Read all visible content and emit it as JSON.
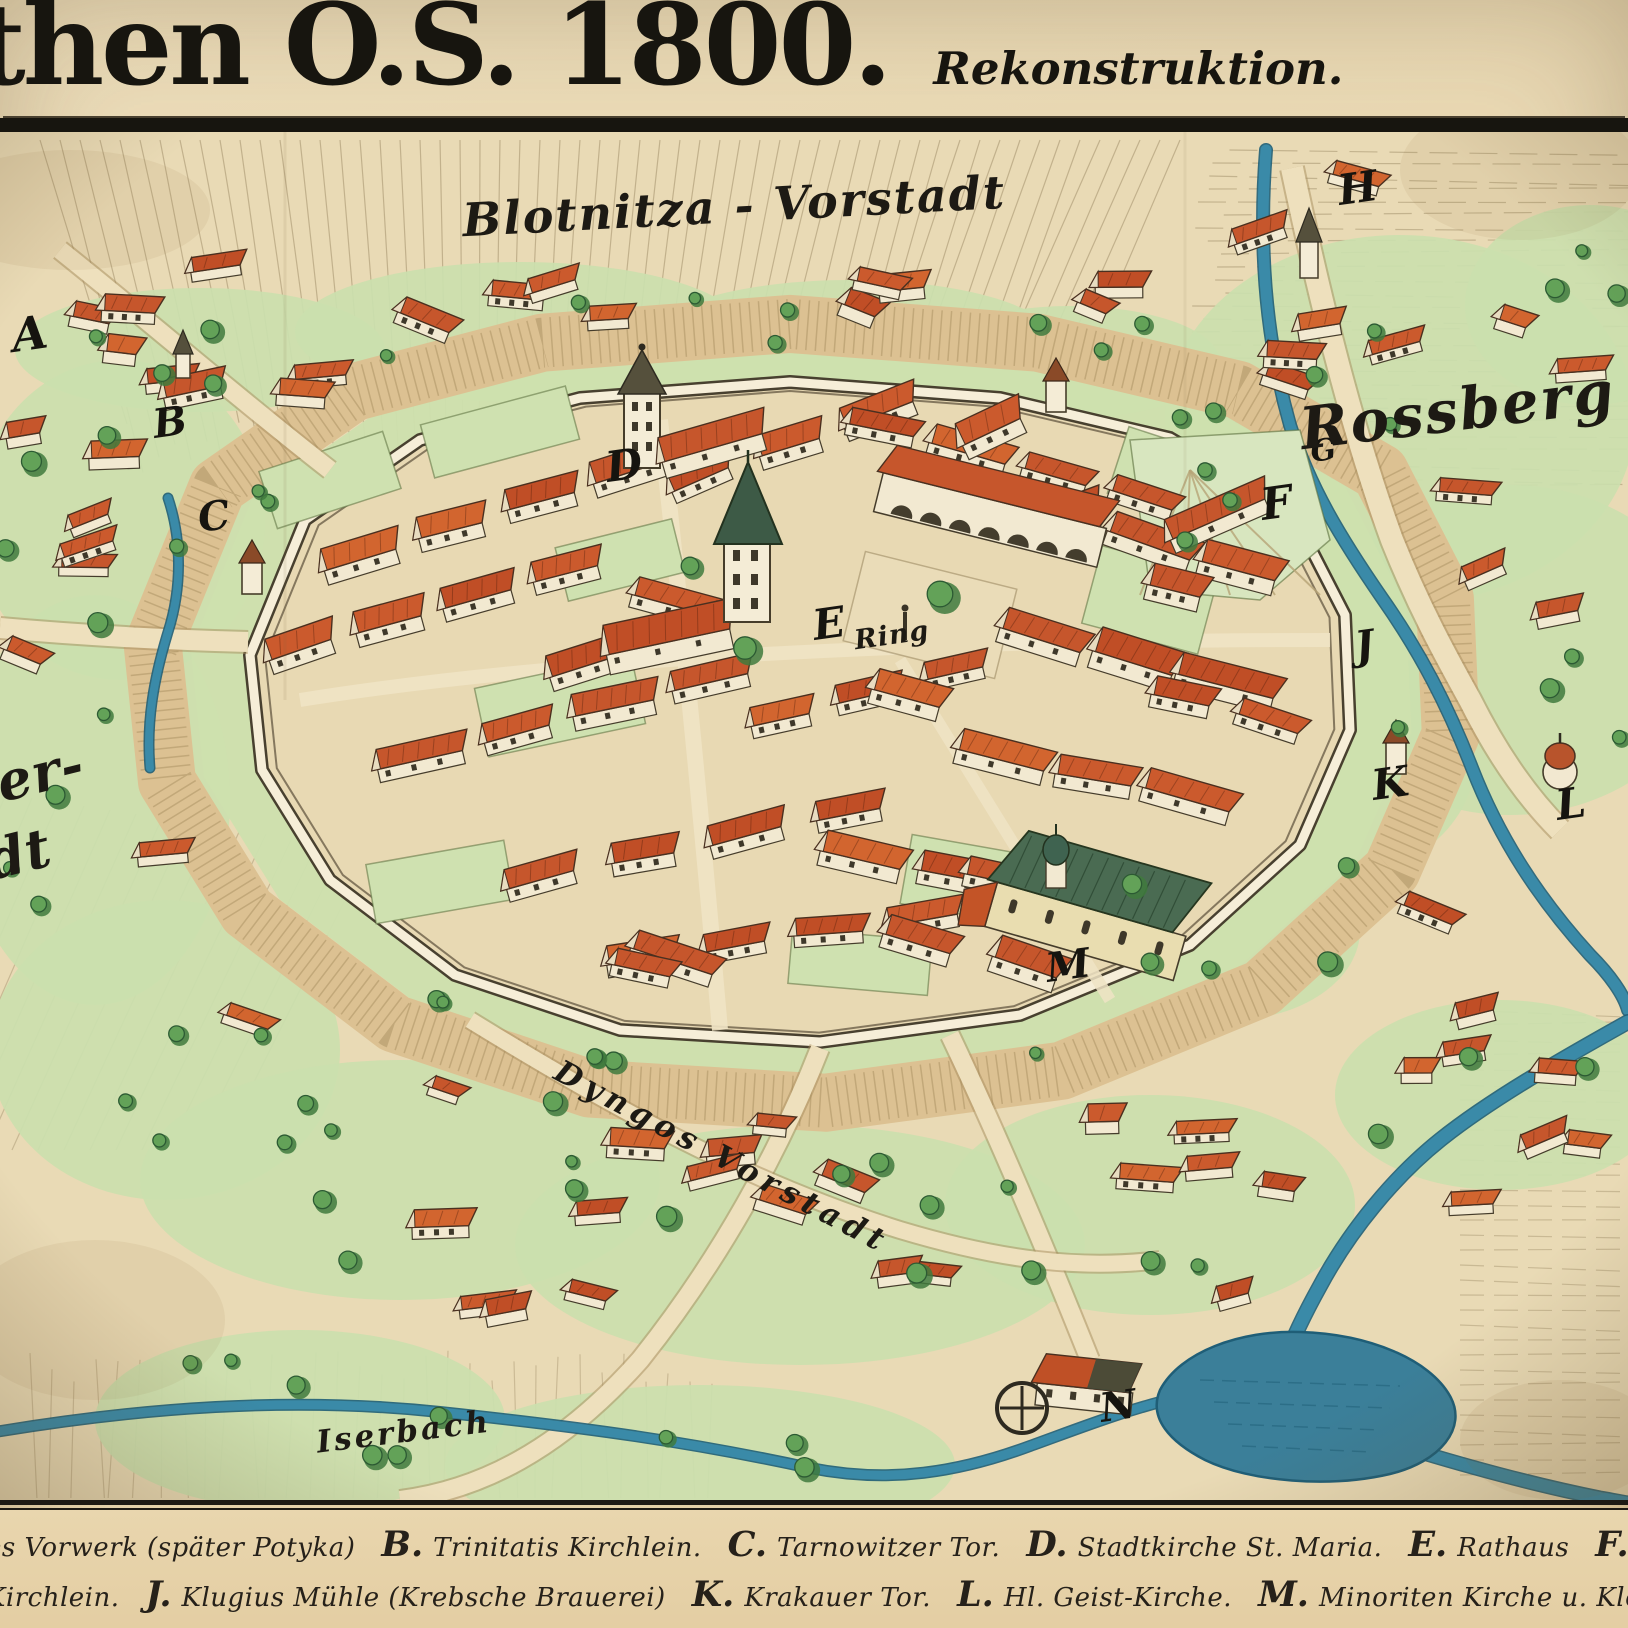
{
  "title": {
    "main": "then O.S. 1800.",
    "sub": "Rekonstruktion."
  },
  "map": {
    "place_labels": [
      {
        "id": "blotnitza-vorstadt",
        "text": "Blotnitza - Vorstadt",
        "x": 735,
        "y": 222,
        "size": 46,
        "rot": -3,
        "ls": 2,
        "anchor": "middle"
      },
      {
        "id": "rossberg",
        "text": "Rossberg",
        "x": 1460,
        "y": 430,
        "size": 58,
        "rot": -7,
        "ls": 2,
        "anchor": "middle"
      },
      {
        "id": "ring",
        "text": "Ring",
        "x": 893,
        "y": 644,
        "size": 27,
        "rot": -8,
        "ls": 1,
        "anchor": "middle"
      },
      {
        "id": "dyngos-vorstadt",
        "text": "Dyngos Vorstadt",
        "x": 552,
        "y": 1078,
        "size": 31,
        "rot": 28,
        "ls": 6,
        "anchor": "start"
      },
      {
        "id": "iserbach",
        "text": "Iserbach",
        "x": 405,
        "y": 1442,
        "size": 31,
        "rot": -7,
        "ls": 3,
        "anchor": "middle"
      },
      {
        "id": "vorstadt-left-line1",
        "text": "er-",
        "x": 2,
        "y": 802,
        "size": 54,
        "rot": -14,
        "ls": 1,
        "anchor": "start"
      },
      {
        "id": "vorstadt-left-line2",
        "text": "dt",
        "x": -8,
        "y": 880,
        "size": 54,
        "rot": -14,
        "ls": 1,
        "anchor": "start"
      }
    ],
    "markers": [
      {
        "letter": "A",
        "x": 14,
        "y": 352,
        "size": 46
      },
      {
        "letter": "B",
        "x": 155,
        "y": 438,
        "size": 40
      },
      {
        "letter": "C",
        "x": 200,
        "y": 532,
        "size": 40
      },
      {
        "letter": "D",
        "x": 608,
        "y": 482,
        "size": 42
      },
      {
        "letter": "E",
        "x": 815,
        "y": 640,
        "size": 42
      },
      {
        "letter": "F",
        "x": 1263,
        "y": 520,
        "size": 44
      },
      {
        "letter": "G",
        "x": 1312,
        "y": 462,
        "size": 30
      },
      {
        "letter": "H",
        "x": 1340,
        "y": 205,
        "size": 42
      },
      {
        "letter": "J",
        "x": 1357,
        "y": 660,
        "size": 40
      },
      {
        "letter": "K",
        "x": 1374,
        "y": 800,
        "size": 42
      },
      {
        "letter": "L",
        "x": 1558,
        "y": 820,
        "size": 42
      },
      {
        "letter": "M",
        "x": 1048,
        "y": 982,
        "size": 40
      },
      {
        "letter": "N",
        "x": 1102,
        "y": 1422,
        "size": 40
      }
    ]
  },
  "legend": {
    "line1": {
      "lead": "es Vorwerk (später Potyka)",
      "entries": [
        {
          "letter": "B.",
          "text": "Trinitatis Kirchlein."
        },
        {
          "letter": "C.",
          "text": "Tarnowitzer Tor."
        },
        {
          "letter": "D.",
          "text": "Stadtkirche St. Maria."
        },
        {
          "letter": "E.",
          "text": "Rathaus"
        },
        {
          "letter": "F.",
          "text": "Cramer'scher Garten"
        }
      ],
      "tail": "G"
    },
    "line2": {
      "lead": "Kirchlein.",
      "entries": [
        {
          "letter": "J.",
          "text": "Klugius Mühle (Krebsche Brauerei)"
        },
        {
          "letter": "K.",
          "text": "Krakauer Tor."
        },
        {
          "letter": "L.",
          "text": "Hl. Geist-Kirche."
        },
        {
          "letter": "M.",
          "text": "Minoriten Kirche u. Kloster m. Garten -1810."
        }
      ],
      "tail": "N"
    }
  },
  "colors": {
    "ink": "#211e18",
    "parchment": "#e9d8b3",
    "green": "#cbdfae",
    "tree": "#5d9a55",
    "roof": "#c6562c",
    "water": "#3585a3",
    "wall_cream": "#f6eed8",
    "moat": "#dcc192",
    "minoriten_roof": "#4a6b52",
    "pond": "#3b7f99"
  }
}
